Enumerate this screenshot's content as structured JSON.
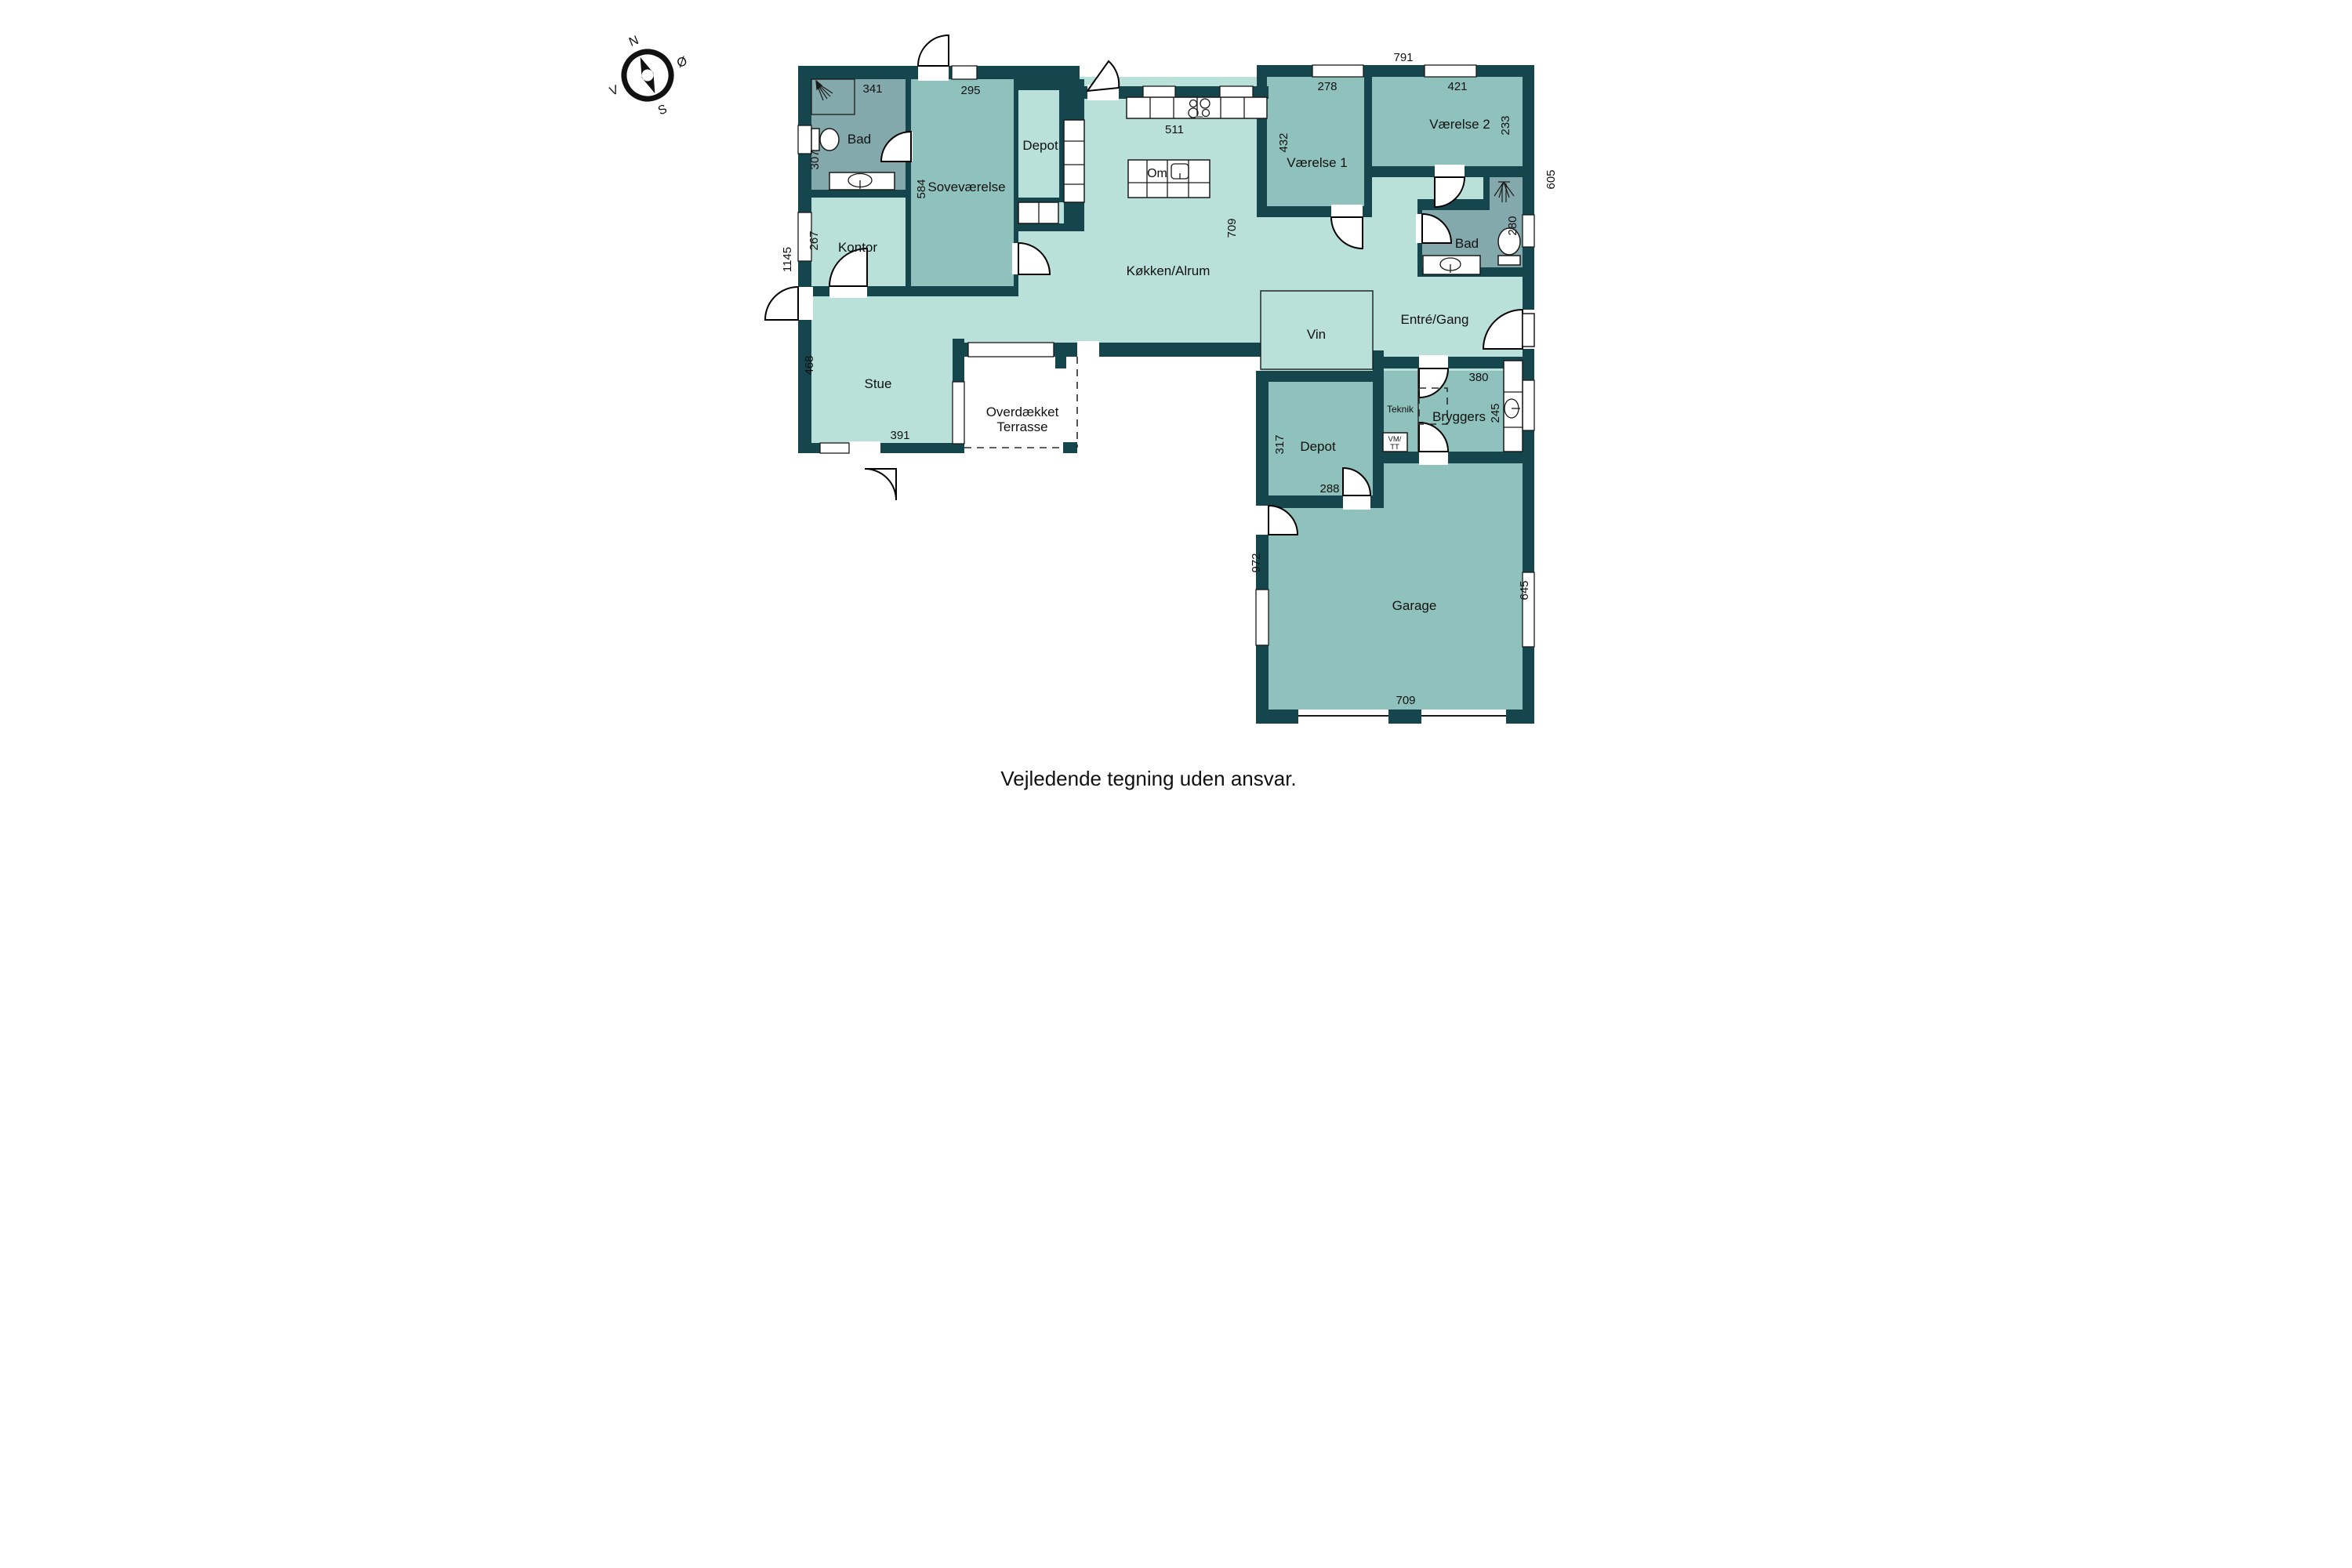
{
  "disclaimer": "Vejledende tegning uden ansvar.",
  "compass": {
    "n": "N",
    "e": "Ø",
    "s": "S",
    "w": "V"
  },
  "colors": {
    "wall": "#15464e",
    "floor_light": "#b9e1d9",
    "floor_medium": "#8fc2bc",
    "floor_bath": "#84a9ac",
    "background": "#ffffff"
  },
  "rooms": {
    "bad1": "Bad",
    "sovevaerelse": "Soveværelse",
    "depot1": "Depot",
    "kontor": "Kontor",
    "stue": "Stue",
    "kokken_alrum": "Køkken/Alrum",
    "vaerelse1": "Værelse 1",
    "vaerelse2": "Værelse 2",
    "bad2": "Bad",
    "entre_gang": "Entré/Gang",
    "teknik": "Teknik",
    "bryggers": "Bryggers",
    "depot2": "Depot",
    "garage": "Garage",
    "terrasse1": "Overdækket",
    "terrasse2": "Terrasse",
    "vin": "Vin",
    "om": "Om",
    "vm1": "VM/",
    "vm2": "TT"
  },
  "dimensions": {
    "d341": "341",
    "d295": "295",
    "d511": "511",
    "d278": "278",
    "d791": "791",
    "d421": "421",
    "d233": "233",
    "d605": "605",
    "d432": "432",
    "d307": "307",
    "d267": "267",
    "d1145": "1145",
    "d584": "584",
    "d468": "468",
    "d391": "391",
    "d709k": "709",
    "d280": "280",
    "d380": "380",
    "d245": "245",
    "d317": "317",
    "d288": "288",
    "d972": "972",
    "d645": "645",
    "d709g": "709"
  }
}
